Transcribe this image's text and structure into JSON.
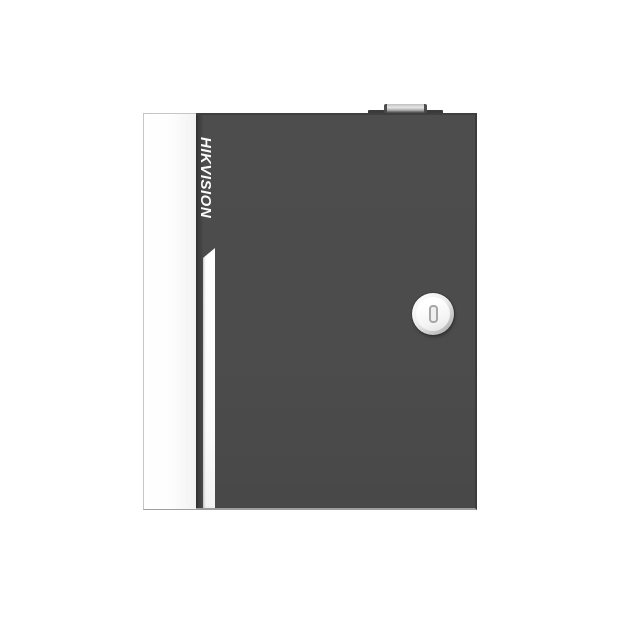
{
  "photo": {
    "background_color": "#ffffff",
    "subject": "front view of a wall-mount metal enclosure (access controller cabinet)"
  },
  "device": {
    "brand_logo": "HIKVISION",
    "logo_color": "#fcfcfc",
    "door_color": "#4c4c4c",
    "side_panel_color": "#ffffff",
    "accent_stripe_color": "#ffffff",
    "hinge_recess_color": "#3a3a3a",
    "bottom_edge_highlight_color": "#9e9e9e",
    "lock": {
      "ring_color": "#ededed",
      "face_color": "#ffffff",
      "keyhole_color": "#a6a6a6"
    },
    "top_connector_color": "#3a3a3a"
  }
}
